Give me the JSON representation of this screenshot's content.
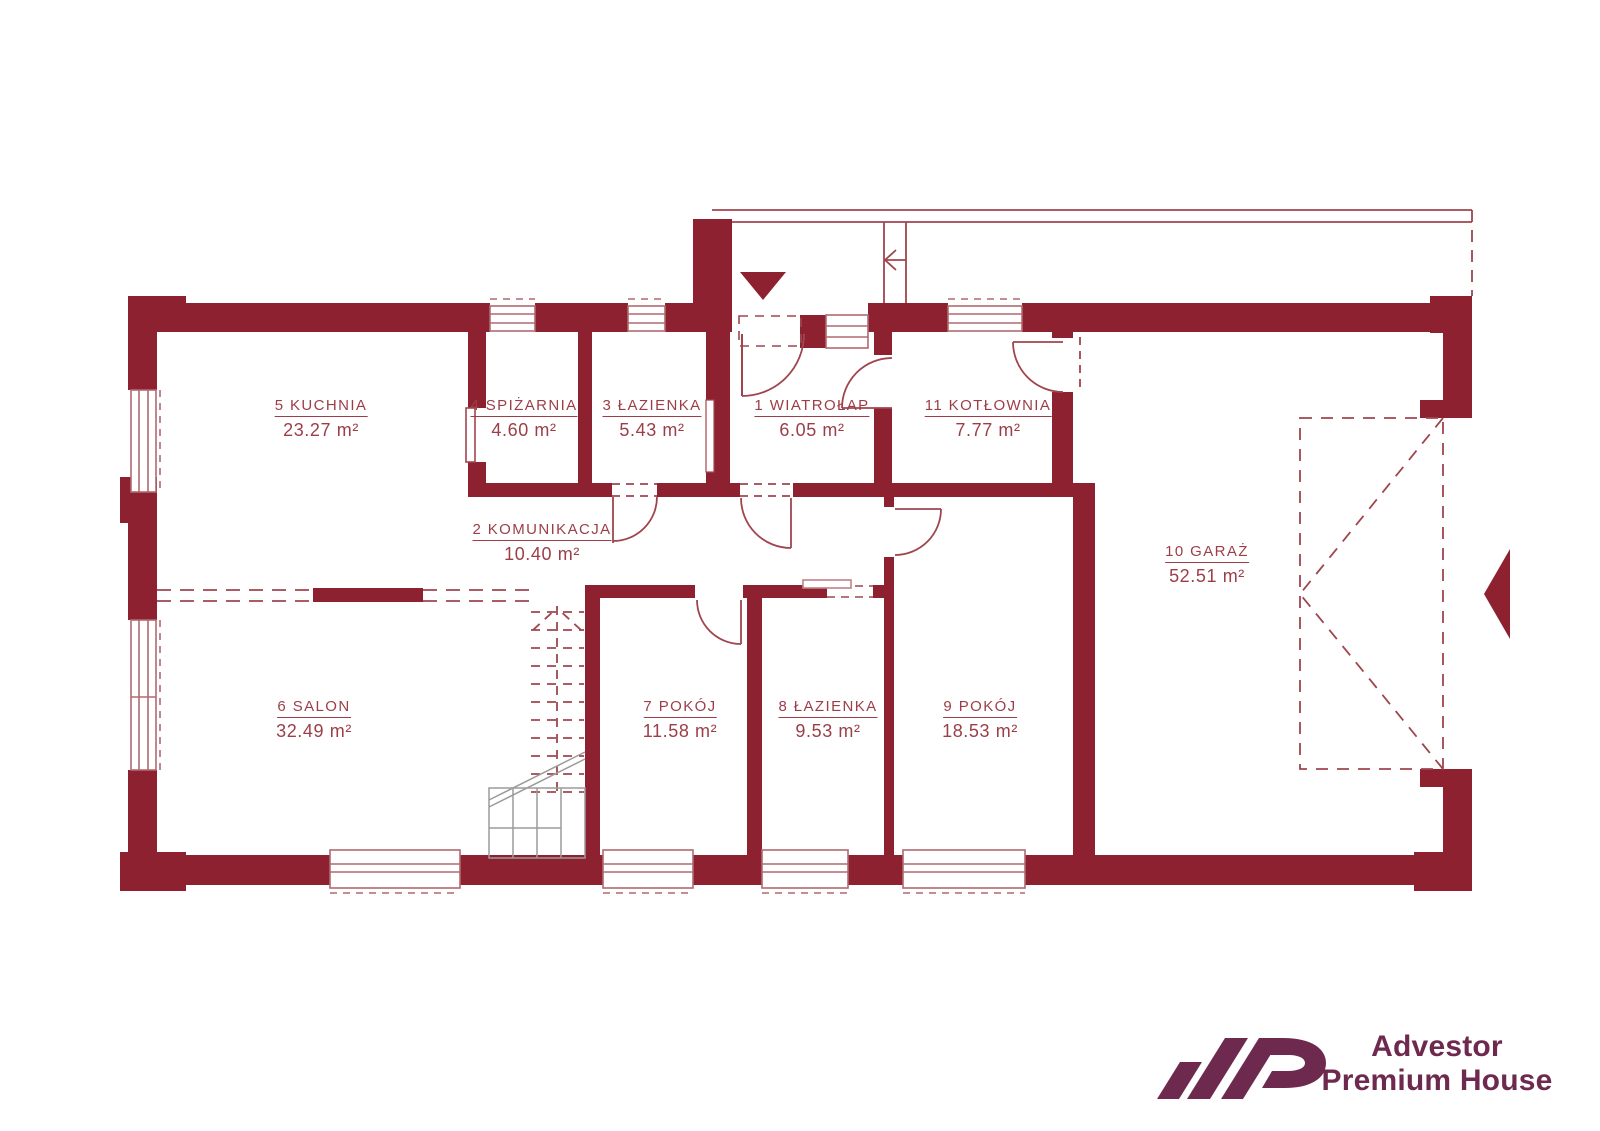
{
  "rooms": {
    "wiatrolap": {
      "label": "1 WIATROŁAP",
      "area": "6.05 m²"
    },
    "komunikacja": {
      "label": "2 KOMUNIKACJA",
      "area": "10.40 m²"
    },
    "lazienka3": {
      "label": "3 ŁAZIENKA",
      "area": "5.43 m²"
    },
    "spizarnia": {
      "label": "4 SPIŻARNIA",
      "area": "4.60 m²"
    },
    "kuchnia": {
      "label": "5 KUCHNIA",
      "area": "23.27 m²"
    },
    "salon": {
      "label": "6 SALON",
      "area": "32.49 m²"
    },
    "pokoj7": {
      "label": "7 POKÓJ",
      "area": "11.58 m²"
    },
    "lazienka8": {
      "label": "8 ŁAZIENKA",
      "area": "9.53 m²"
    },
    "pokoj9": {
      "label": "9 POKÓJ",
      "area": "18.53 m²"
    },
    "garaz": {
      "label": "10 GARAŻ",
      "area": "52.51 m²"
    },
    "kotlownia": {
      "label": "11 KOTŁOWNIA",
      "area": "7.77 m²"
    }
  },
  "branding": {
    "monogram": "AP",
    "name_line1": "Advestor",
    "name_line2": "Premium House"
  },
  "colors": {
    "wall": "#8e2130",
    "thin_line": "#a0454e",
    "window_frame": "#b06a70",
    "label_text": "#9c3e47",
    "stairs_gray": "#9b9b9b",
    "logo": "#6e2a4e"
  }
}
